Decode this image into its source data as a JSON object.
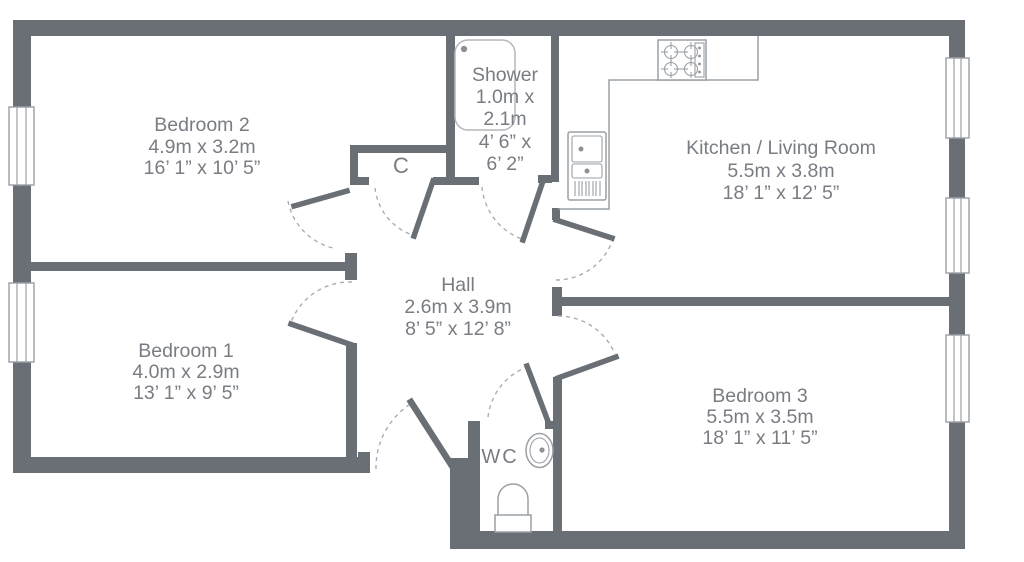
{
  "floorplan": {
    "rooms": {
      "bedroom2": {
        "name": "Bedroom 2",
        "metric": "4.9m x 3.2m",
        "imperial": "16’ 1” x 10’ 5”"
      },
      "bedroom1": {
        "name": "Bedroom 1",
        "metric": "4.0m x 2.9m",
        "imperial": "13’ 1” x 9’ 5”"
      },
      "bedroom3": {
        "name": "Bedroom 3",
        "metric": "5.5m x 3.5m",
        "imperial": "18’ 1” x 11’ 5”"
      },
      "kitchen": {
        "name": "Kitchen / Living Room",
        "metric": "5.5m x 3.8m",
        "imperial": "18’ 1” x 12’ 5”"
      },
      "hall": {
        "name": "Hall",
        "metric": "2.6m x 3.9m",
        "imperial": "8’ 5” x 12’ 8”"
      },
      "shower": {
        "name": "Shower",
        "line1": "1.0m x",
        "line2": "2.1m",
        "line3": "4’ 6” x",
        "line4": "6’ 2”"
      },
      "wc": {
        "name": "WC"
      },
      "closet": {
        "name": "C"
      }
    },
    "fixtures": [
      "shower-tray",
      "hob",
      "sink-unit",
      "kitchen-counter",
      "wash-basin",
      "toilet",
      "window",
      "door-swing"
    ],
    "colors": {
      "wall": "#6a6f76",
      "label": "#797d83",
      "fixture_line": "#9aa0a5",
      "door_arc": "#a9adb2"
    }
  }
}
